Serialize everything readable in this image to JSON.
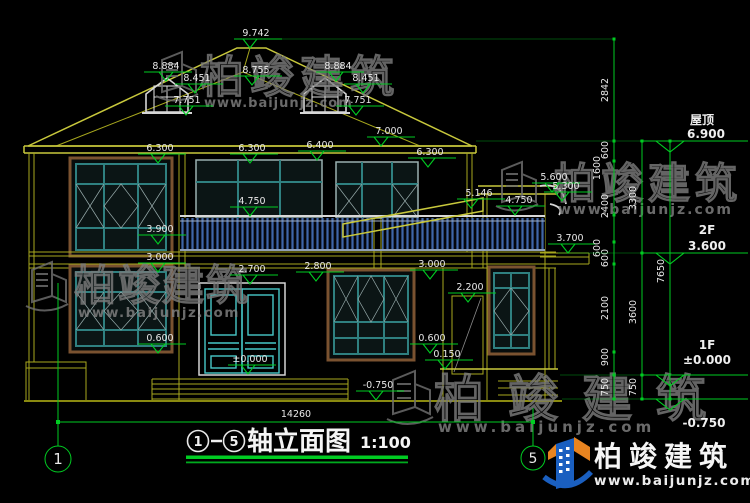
{
  "title": {
    "axis_from": "1",
    "axis_to": "5",
    "text": "轴立面图",
    "scale": "1:100"
  },
  "axes": {
    "left": "1",
    "right": "5"
  },
  "width_dim": "14260",
  "marks": {
    "peak": "9.742",
    "dormer_top_l": "8.884",
    "dormer_mid_l": "8.451",
    "dormer_base_l": "7.751",
    "rear_ridge": "8.755",
    "dormer_top_r": "8.884",
    "dormer_mid_r": "8.451",
    "dormer_base_r": "7.751",
    "eave_right": "7.000",
    "parapet_mid": "6.400",
    "f2_head_l": "6.300",
    "f2_head_m": "6.300",
    "f2_head_r": "6.300",
    "porch_roof": "5.146",
    "bay_top": "5.600",
    "bay_eave": "5.300",
    "rail_l": "4.750",
    "rail_r": "4.750",
    "f2_sill_l": "3.900",
    "canopy": "3.700",
    "f1_head_l": "3.000",
    "door_head": "2.700",
    "f1_head_m": "2.800",
    "f1_head_r": "3.000",
    "porch_door_head": "2.200",
    "f1_sill_l": "0.600",
    "f1_sill_m": "0.600",
    "porch_floor": "0.150",
    "floor_zero": "±0.000",
    "ground_mid": "-0.750"
  },
  "levels": {
    "roof_label": "屋顶",
    "roof": "6.900",
    "f2_label": "2F",
    "f2": "3.600",
    "f1_label": "1F",
    "f1": "±0.000",
    "ground": "-0.750"
  },
  "chains": {
    "c1": [
      "2842",
      "600",
      "1600",
      "2400",
      "600",
      "600",
      "2100",
      "900",
      "750"
    ],
    "c2": [
      "3300",
      "3600",
      "750"
    ],
    "c3": [
      "7650"
    ]
  },
  "watermark": {
    "cn": "柏竣建筑",
    "url": "www.baijunjz.com"
  },
  "logo": {
    "cn": "柏竣建筑",
    "url": "www.baijunjz.com"
  },
  "colors": {
    "dim_green": "#00cc22",
    "line_yellow": "#a8a81e",
    "text_white": "#e8e8e8",
    "window_teal": "#2f8080",
    "frame_brown": "#7a5230",
    "rail_blue": "#3f66a8",
    "logo_blue": "#1a5fc0",
    "logo_orange": "#e88420",
    "watermark_gray": "#7b7b7b"
  }
}
